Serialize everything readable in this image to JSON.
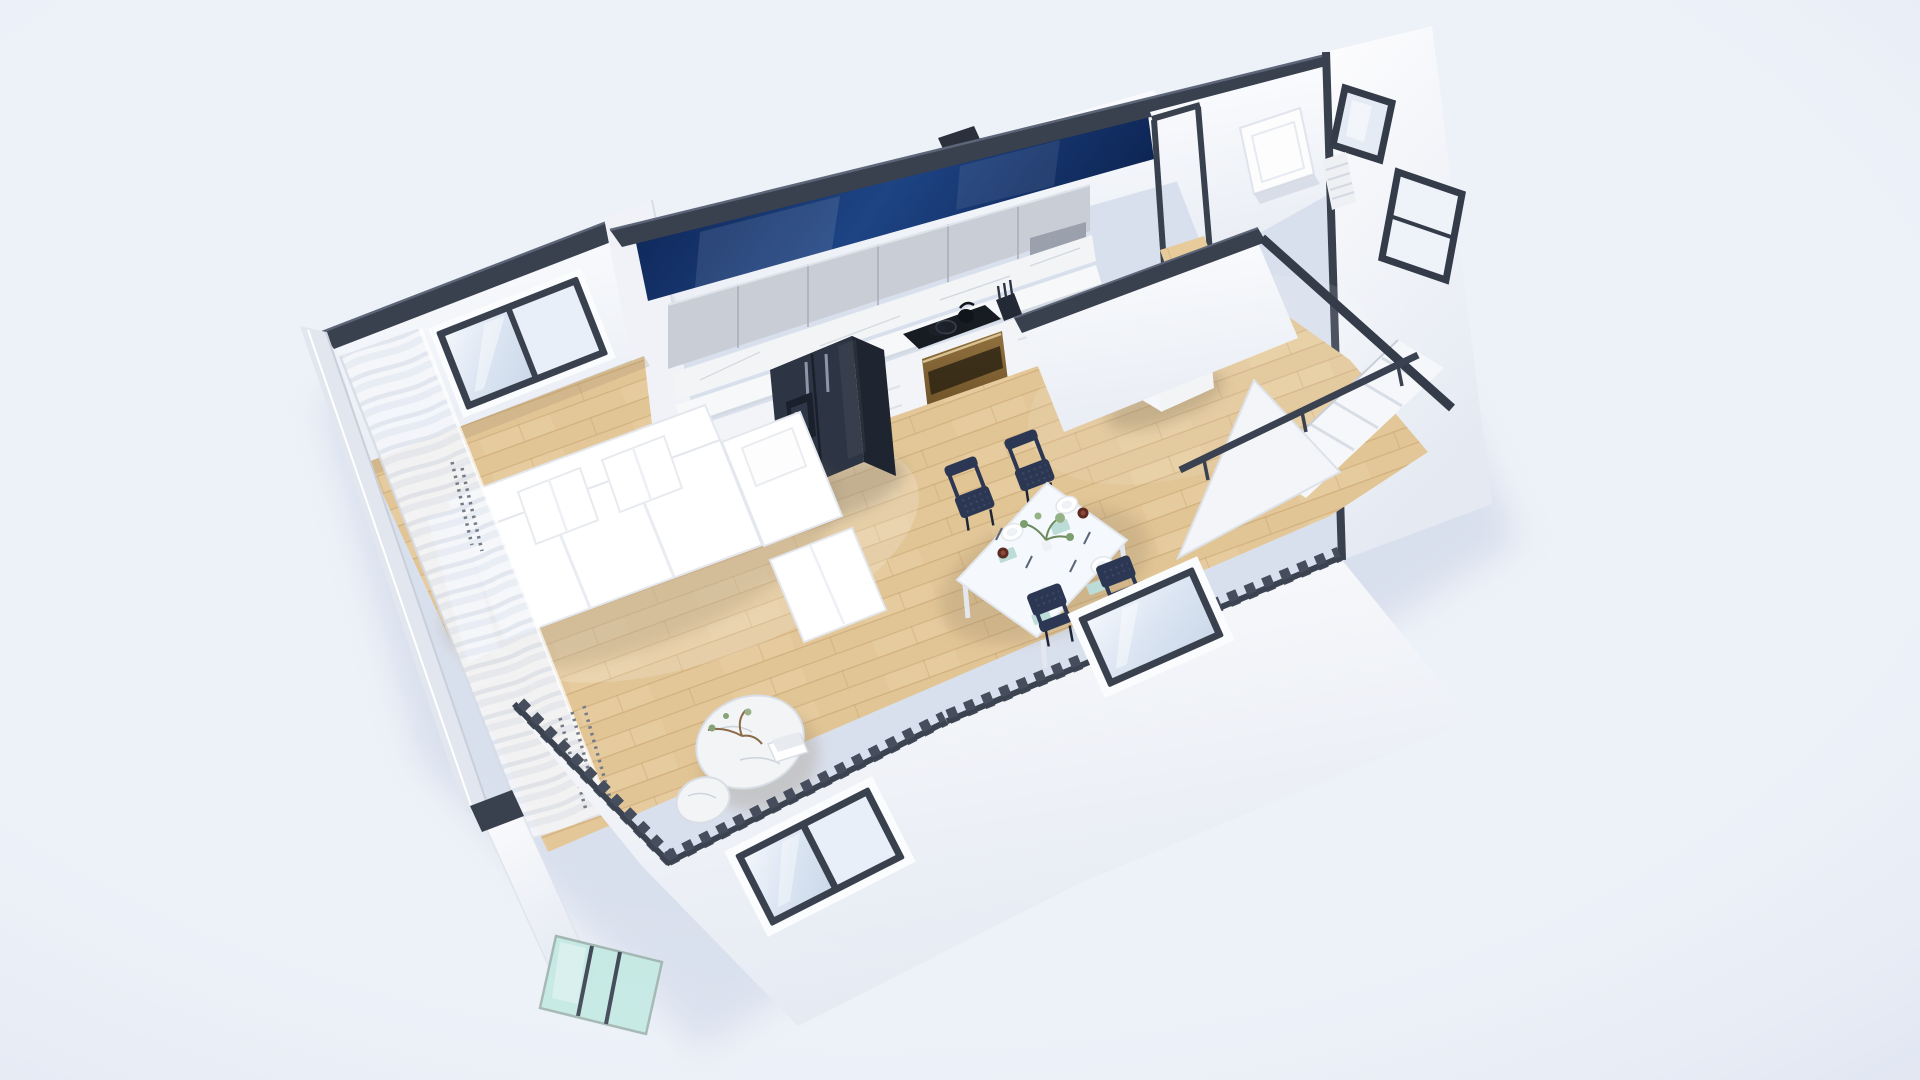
{
  "image": {
    "type": "3d-floor-plan-render",
    "description": "Isometric cutaway render of a small modern apartment with open kitchen, dining area, living room, bathroom and staircase on a light blue-white background"
  },
  "scene": {
    "rooms": [
      "living-room",
      "dining-area",
      "kitchen",
      "hallway",
      "bathroom",
      "staircase",
      "balcony"
    ],
    "furniture": [
      "white-sectional-sofa",
      "round-marble-coffee-table",
      "small-marble-side-table",
      "white-dining-table",
      "navy-mesh-chairs-x4",
      "dark-refrigerator",
      "gray-upper-cabinets",
      "marble-countertop",
      "black-cooktop",
      "brass-oven",
      "sink-island",
      "white-leaning-door",
      "sheer-curtains",
      "teal-glass-panel",
      "dark-framed-windows",
      "stair-railing"
    ]
  },
  "palette": {
    "bg": "#edf1f8",
    "vignette": "#c7d1e6",
    "building_shadow": "#c9d3e5",
    "wall_white": "#fafbfe",
    "wall_shade": "#edf0f6",
    "wall_outer": "#f5f7fb",
    "cap_dark": "#39404e",
    "cap_edge": "#242a35",
    "cap_light": "#5d6678",
    "seam_light": "#eef0f5",
    "navy1": "#0a1f4c",
    "navy2": "#1e4484",
    "wood1": "#ecd2a4",
    "wood2": "#e3c493",
    "wood_line": "#c29a63",
    "marble": "#f2f4f6",
    "marble_edge": "#dde2e9",
    "vein": "#c3cad5",
    "cabinet_gray1": "#c9cdd5",
    "cabinet_gray2": "#b4bac4",
    "drawer_white": "#f3f4f7",
    "nook_dark": "#9aa1ad",
    "fridge1": "#2d3443",
    "fridge2": "#1f2530",
    "fridge_top": "#3c4456",
    "brass1": "#92713f",
    "brass2": "#6e5228",
    "cooktop": "#171b22",
    "glass": "#e2eaf5",
    "glass_dark": "#cfdaea",
    "teal": "#c2e8e1",
    "frame_dark": "#3a414e",
    "sofa": "#ffffff",
    "sofa_shade": "#e9ecf1",
    "table_top": "#f5f8fc",
    "chair_navy": "#2c3753",
    "chair_leg": "#1f2637",
    "napkin": "#bcdcd8",
    "cup": "#5e2a21",
    "plant": "#7c9e6e",
    "plant2": "#95b286",
    "curtain": "#f4f6fa",
    "curtain_fold": "#dde2ec",
    "bead": "#767c88",
    "stair_white": "#f5f7fa",
    "rail_dark": "#3a4150",
    "floor_ao": "#8c7a5e"
  }
}
